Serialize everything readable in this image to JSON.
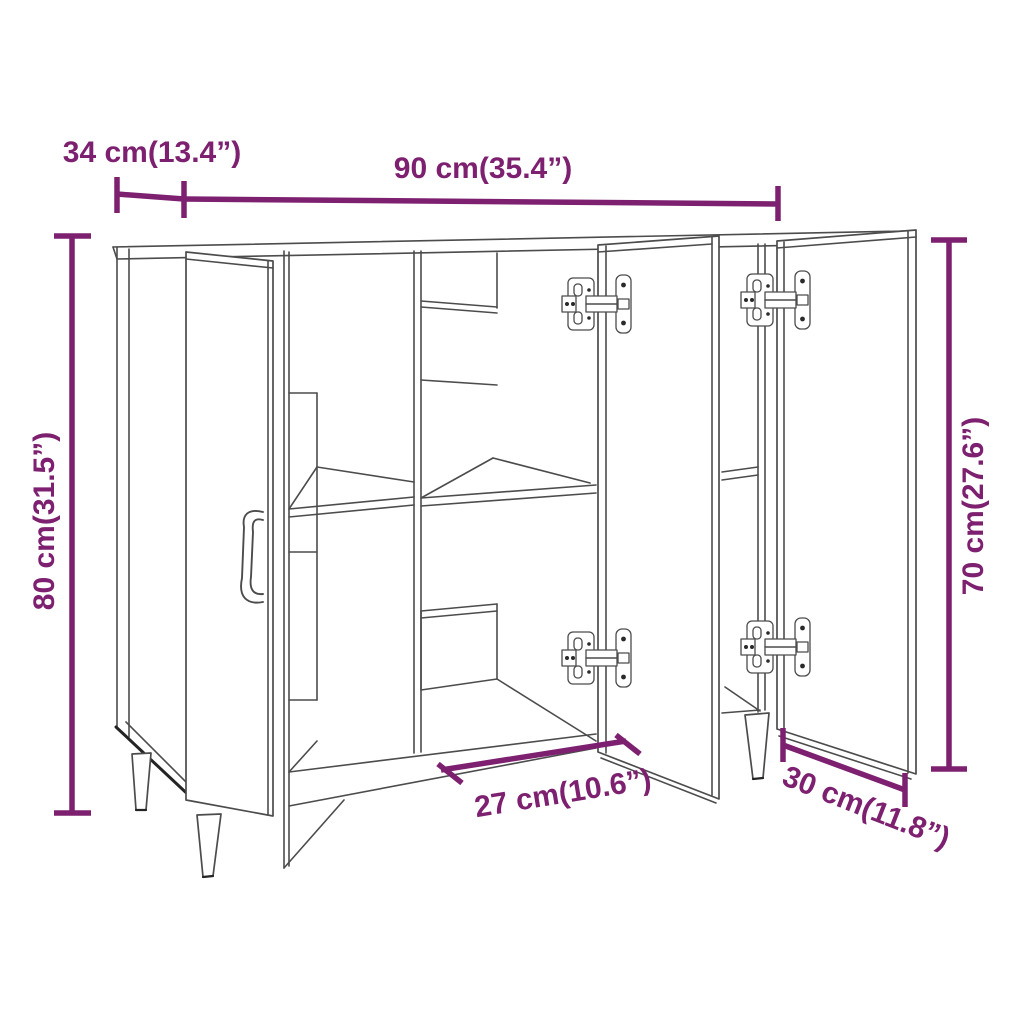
{
  "page": {
    "background": "#ffffff"
  },
  "diagram": {
    "product": "sideboard-with-3-doors-dimension-diagram",
    "accent_color": "#7d2070",
    "line_color": "#4c4c4c",
    "dimensions": [
      {
        "id": "top-depth",
        "label": "34 cm(13.4”)"
      },
      {
        "id": "top-width",
        "label": "90 cm(35.4”)"
      },
      {
        "id": "overall-height",
        "label": "80 cm(31.5”)"
      },
      {
        "id": "door-height",
        "label": "70 cm(27.6”)"
      },
      {
        "id": "compartment-width",
        "label": "27 cm(10.6”)"
      },
      {
        "id": "door-width",
        "label": "30 cm(11.8”)"
      }
    ]
  }
}
